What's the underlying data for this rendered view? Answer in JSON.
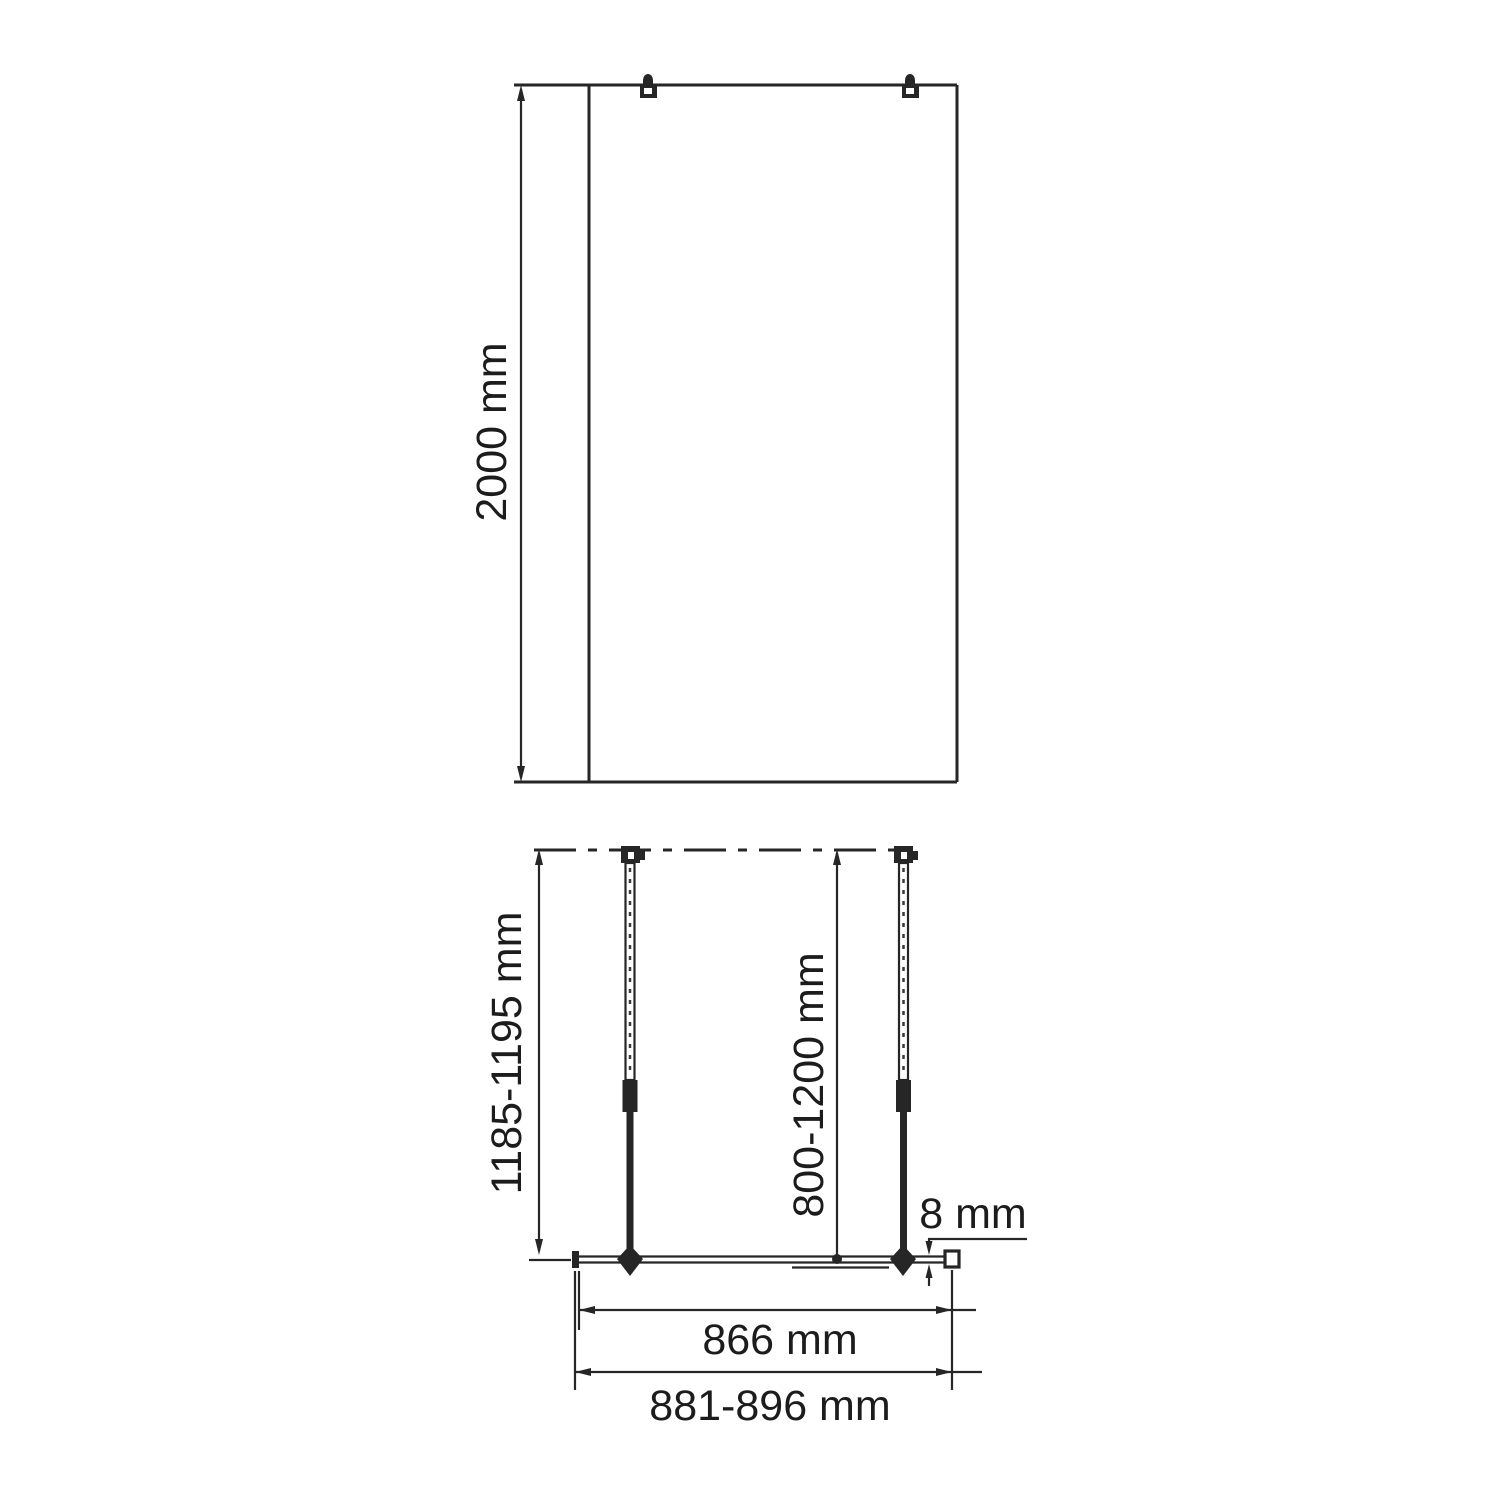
{
  "meta": {
    "background_color": "#ffffff",
    "stroke_color": "#262626",
    "text_color": "#1c1c1c",
    "description": "Technical installation drawing of a walk-in shower glass screen, front elevation and plan view with support bars"
  },
  "front_view": {
    "height_dimension": "2000 mm"
  },
  "plan_view": {
    "support_bar_length_dimension": "1185-1195 mm",
    "wall_distance_dimension": "800-1200 mm",
    "glass_thickness_dimension": "8 mm",
    "glass_width_dimension": "866 mm",
    "overall_width_dimension": "881-896 mm"
  }
}
